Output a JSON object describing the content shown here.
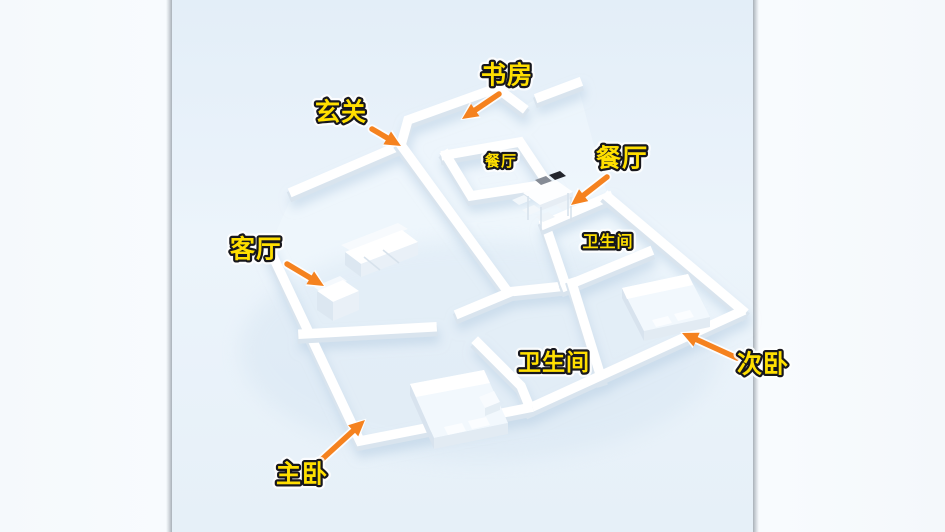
{
  "scene": {
    "type": "3d-floorplan-render",
    "photo_left": 172,
    "photo_right": 753,
    "colors": {
      "label_fill": "#ffdf00",
      "label_outline": "#17171d",
      "label_halo": "#ffffff",
      "arrow": "#f5821f",
      "wall_top": "#ffffff",
      "wall_side": "#d9e4ee",
      "floor_bg_top": "#e3eef8",
      "floor_bg_mid": "#ecf4fb",
      "floor_bg_bottom": "#e6f0f8"
    }
  },
  "floor_labels": [
    {
      "id": "dining-floor-label",
      "text": "餐厅",
      "x": 501,
      "y": 162,
      "size": 15
    },
    {
      "id": "bathroom-floor-label",
      "text": "卫生间",
      "x": 608,
      "y": 243,
      "size": 16
    }
  ],
  "annotations": [
    {
      "id": "study",
      "text": "书房",
      "x": 507,
      "y": 77,
      "size": 25,
      "arrow": {
        "x1": 499,
        "y1": 94,
        "x2": 462,
        "y2": 119
      }
    },
    {
      "id": "entry",
      "text": "玄关",
      "x": 341,
      "y": 114,
      "size": 25,
      "arrow": {
        "x1": 372,
        "y1": 129,
        "x2": 401,
        "y2": 146
      }
    },
    {
      "id": "dining",
      "text": "餐厅",
      "x": 622,
      "y": 160,
      "size": 25,
      "arrow": {
        "x1": 607,
        "y1": 177,
        "x2": 571,
        "y2": 205
      }
    },
    {
      "id": "living",
      "text": "客厅",
      "x": 256,
      "y": 251,
      "size": 25,
      "arrow": {
        "x1": 287,
        "y1": 264,
        "x2": 324,
        "y2": 286
      }
    },
    {
      "id": "bathroom",
      "text": "卫生间",
      "x": 554,
      "y": 364,
      "size": 23,
      "arrow": null
    },
    {
      "id": "second-bedroom",
      "text": "次卧",
      "x": 763,
      "y": 366,
      "size": 25,
      "arrow": {
        "x1": 737,
        "y1": 358,
        "x2": 682,
        "y2": 333
      }
    },
    {
      "id": "master-bedroom",
      "text": "主卧",
      "x": 302,
      "y": 476,
      "size": 25,
      "arrow": {
        "x1": 319,
        "y1": 462,
        "x2": 365,
        "y2": 420
      }
    }
  ]
}
